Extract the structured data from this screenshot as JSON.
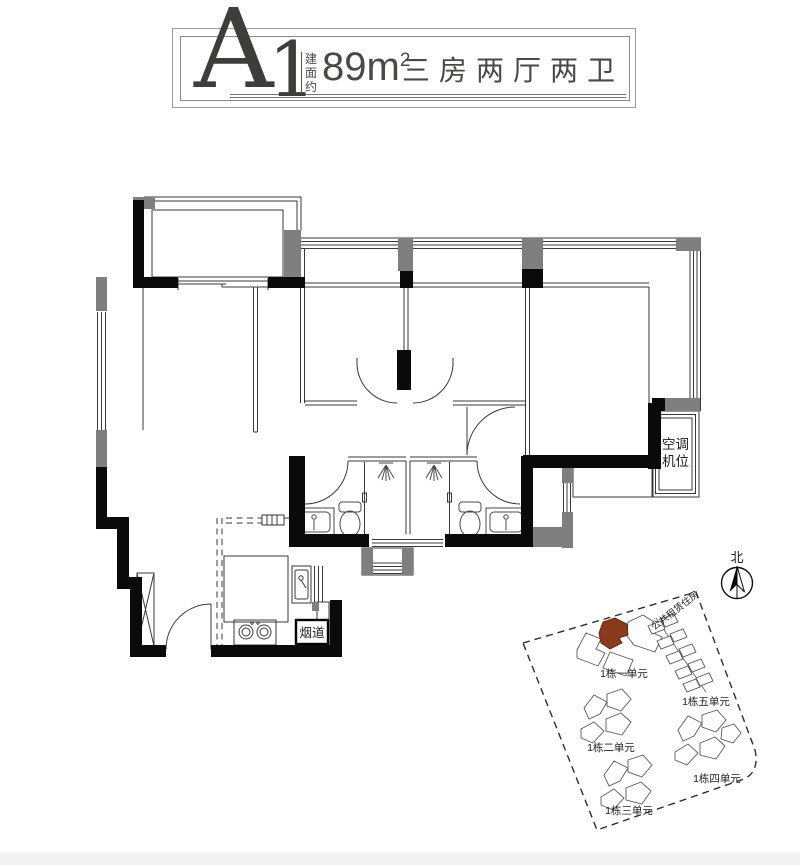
{
  "header": {
    "unit_code_letter": "A",
    "unit_code_number": "1",
    "area_prefix": "建面约",
    "area_value": "89m",
    "area_exponent": "2",
    "layout_text": "三房两厅两卫"
  },
  "plan": {
    "ac_label_line1": "空调",
    "ac_label_line2": "机位",
    "flue_label": "烟道",
    "colors": {
      "wall": "#0a0a0a",
      "column": "#7f7f7f",
      "thin_line": "#3a3a3a",
      "highlight_unit": "#8a3a1d"
    }
  },
  "compass": {
    "north_label": "北"
  },
  "site_plan": {
    "public_rental_label": "公共租赁住房",
    "building_labels": [
      "1栋一单元",
      "1栋二单元",
      "1栋三单元",
      "1栋四单元",
      "1栋五单元"
    ]
  }
}
